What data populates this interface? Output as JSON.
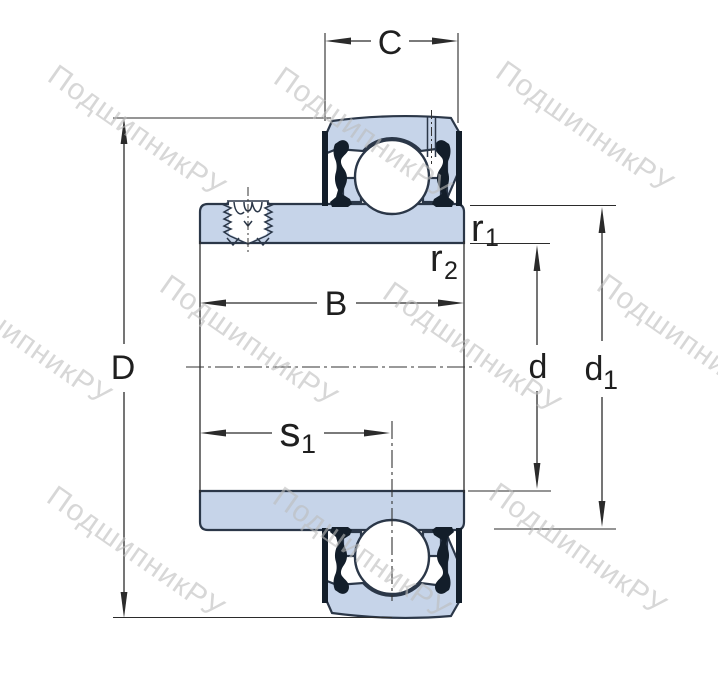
{
  "drawing": {
    "title": "insert-bearing cross-section technical drawing",
    "dimension_labels": {
      "C": "C",
      "D": "D",
      "B": "B",
      "d": "d",
      "s1": {
        "base": "s",
        "sub": "1"
      },
      "d1": {
        "base": "d",
        "sub": "1"
      },
      "r1": {
        "base": "r",
        "sub": "1"
      },
      "r2": {
        "base": "r",
        "sub": "2"
      }
    }
  },
  "watermark": {
    "text": "ПодшипникРУ"
  },
  "colors": {
    "part-fill": "#c6d4e9",
    "part-outline": "#2b3748",
    "seal": "#131e2a",
    "dimension-line": "#2b2b2b",
    "label-text": "#1f1f1f",
    "watermark": "#bcbcbc",
    "background": "#ffffff"
  }
}
